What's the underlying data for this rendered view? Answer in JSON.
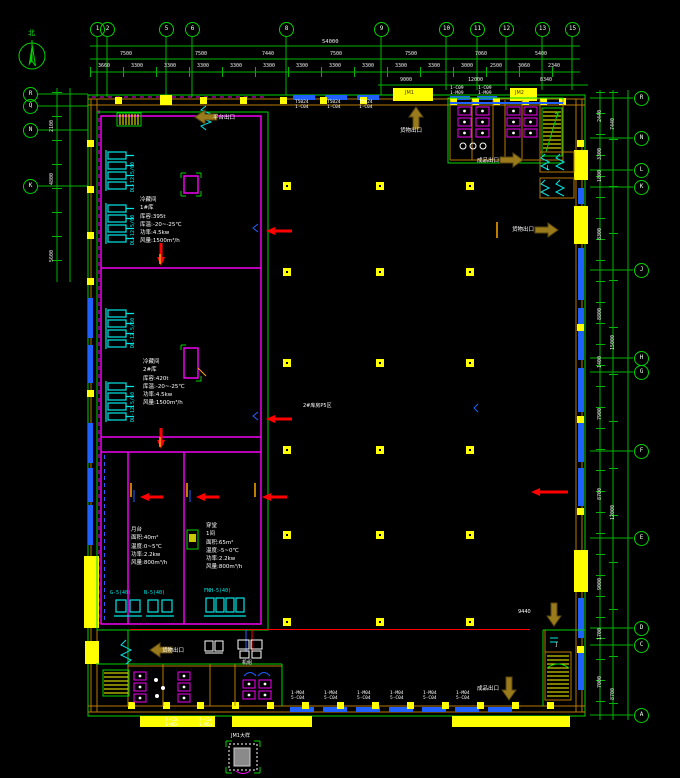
{
  "compass": {
    "label": "北"
  },
  "grid_top": [
    {
      "label": "1",
      "x": 97,
      "y": 29
    },
    {
      "label": "2",
      "x": 107,
      "y": 29
    },
    {
      "label": "5",
      "x": 166,
      "y": 29
    },
    {
      "label": "6",
      "x": 192,
      "y": 29
    },
    {
      "label": "8",
      "x": 286,
      "y": 29
    },
    {
      "label": "9",
      "x": 381,
      "y": 29
    },
    {
      "label": "10",
      "x": 446,
      "y": 29
    },
    {
      "label": "11",
      "x": 477,
      "y": 29
    },
    {
      "label": "12",
      "x": 506,
      "y": 29
    },
    {
      "label": "13",
      "x": 542,
      "y": 29
    },
    {
      "label": "15",
      "x": 572,
      "y": 29
    }
  ],
  "grid_left": [
    {
      "label": "R",
      "x": 30,
      "y": 94
    },
    {
      "label": "Q",
      "x": 30,
      "y": 106
    },
    {
      "label": "N",
      "x": 30,
      "y": 130
    },
    {
      "label": "K",
      "x": 30,
      "y": 186
    }
  ],
  "grid_right": [
    {
      "label": "R",
      "x": 641,
      "y": 98
    },
    {
      "label": "N",
      "x": 641,
      "y": 138
    },
    {
      "label": "L",
      "x": 641,
      "y": 170
    },
    {
      "label": "K",
      "x": 641,
      "y": 187
    },
    {
      "label": "J",
      "x": 641,
      "y": 270
    },
    {
      "label": "H",
      "x": 641,
      "y": 358
    },
    {
      "label": "G",
      "x": 641,
      "y": 372
    },
    {
      "label": "F",
      "x": 641,
      "y": 451
    },
    {
      "label": "E",
      "x": 641,
      "y": 538
    },
    {
      "label": "D",
      "x": 641,
      "y": 628
    },
    {
      "label": "C",
      "x": 641,
      "y": 645
    },
    {
      "label": "A",
      "x": 641,
      "y": 715
    }
  ],
  "dims_top_total": [
    {
      "label": "54000",
      "x": 322,
      "y": 39
    }
  ],
  "dims_top_row1": [
    {
      "label": "7500",
      "x": 120,
      "y": 52
    },
    {
      "label": "7500",
      "x": 195,
      "y": 52
    },
    {
      "label": "7440",
      "x": 262,
      "y": 52
    },
    {
      "label": "7500",
      "x": 330,
      "y": 52
    },
    {
      "label": "7500",
      "x": 405,
      "y": 52
    },
    {
      "label": "7060",
      "x": 475,
      "y": 52
    },
    {
      "label": "5400",
      "x": 535,
      "y": 52
    }
  ],
  "dims_top_row2": [
    {
      "label": "3660",
      "x": 98,
      "y": 64
    },
    {
      "label": "3300",
      "x": 131,
      "y": 64
    },
    {
      "label": "3300",
      "x": 164,
      "y": 64
    },
    {
      "label": "3300",
      "x": 197,
      "y": 64
    },
    {
      "label": "3300",
      "x": 230,
      "y": 64
    },
    {
      "label": "3300",
      "x": 263,
      "y": 64
    },
    {
      "label": "3300",
      "x": 296,
      "y": 64
    },
    {
      "label": "3300",
      "x": 329,
      "y": 64
    },
    {
      "label": "3300",
      "x": 362,
      "y": 64
    },
    {
      "label": "3300",
      "x": 395,
      "y": 64
    },
    {
      "label": "3300",
      "x": 428,
      "y": 64
    },
    {
      "label": "3000",
      "x": 461,
      "y": 64
    },
    {
      "label": "2500",
      "x": 490,
      "y": 64
    },
    {
      "label": "3060",
      "x": 518,
      "y": 64
    },
    {
      "label": "2340",
      "x": 548,
      "y": 64
    }
  ],
  "dims_top_row3": [
    {
      "label": "9000",
      "x": 400,
      "y": 78
    },
    {
      "label": "12000",
      "x": 468,
      "y": 78
    },
    {
      "label": "8340",
      "x": 540,
      "y": 78
    }
  ],
  "dims_left": [
    {
      "label": "2100",
      "x": 50,
      "y": 132,
      "r": -90
    },
    {
      "label": "4800",
      "x": 50,
      "y": 185,
      "r": -90
    },
    {
      "label": "5600",
      "x": 50,
      "y": 262,
      "r": -90
    }
  ],
  "dims_right": [
    {
      "label": "2440",
      "x": 598,
      "y": 122,
      "r": -90
    },
    {
      "label": "3300",
      "x": 598,
      "y": 160,
      "r": -90
    },
    {
      "label": "1800",
      "x": 598,
      "y": 182,
      "r": -90
    },
    {
      "label": "8300",
      "x": 598,
      "y": 240,
      "r": -90
    },
    {
      "label": "8800",
      "x": 598,
      "y": 320,
      "r": -90
    },
    {
      "label": "1400",
      "x": 598,
      "y": 368,
      "r": -90
    },
    {
      "label": "7900",
      "x": 598,
      "y": 420,
      "r": -90
    },
    {
      "label": "8700",
      "x": 598,
      "y": 500,
      "r": -90
    },
    {
      "label": "9000",
      "x": 598,
      "y": 590,
      "r": -90
    },
    {
      "label": "1700",
      "x": 598,
      "y": 640,
      "r": -90
    },
    {
      "label": "7000",
      "x": 598,
      "y": 688,
      "r": -90
    },
    {
      "label": "7440",
      "x": 611,
      "y": 130,
      "r": -90
    },
    {
      "label": "15000",
      "x": 611,
      "y": 350,
      "r": -90
    },
    {
      "label": "12000",
      "x": 611,
      "y": 520,
      "r": -90
    },
    {
      "label": "8700",
      "x": 611,
      "y": 700,
      "r": -90
    }
  ],
  "window_labels_top": [
    {
      "l1": "T5024",
      "l2": "1-C04",
      "x": 295,
      "y": 100
    },
    {
      "l1": "T5024",
      "l2": "1-C04",
      "x": 327,
      "y": 100
    },
    {
      "l1": "T5024",
      "l2": "1-C04",
      "x": 359,
      "y": 100
    },
    {
      "l1": "1-C09",
      "l2": "1-M09",
      "x": 450,
      "y": 86
    },
    {
      "l1": "1-C09",
      "l2": "1-M09",
      "x": 478,
      "y": 86
    }
  ],
  "window_labels_bottom": [
    {
      "l1": "1-M04",
      "l2": "5-C04",
      "x": 291,
      "y": 691
    },
    {
      "l1": "1-M04",
      "l2": "5-C04",
      "x": 324,
      "y": 691
    },
    {
      "l1": "1-M04",
      "l2": "5-C04",
      "x": 357,
      "y": 691
    },
    {
      "l1": "1-M04",
      "l2": "5-C04",
      "x": 390,
      "y": 691
    },
    {
      "l1": "1-M04",
      "l2": "5-C04",
      "x": 423,
      "y": 691
    },
    {
      "l1": "1-M04",
      "l2": "5-C04",
      "x": 456,
      "y": 691
    },
    {
      "l1": "7-C04",
      "l2": "1-M04",
      "x": 165,
      "y": 718
    },
    {
      "l1": "7-C04",
      "l2": "1-M04",
      "x": 199,
      "y": 718
    }
  ],
  "exit_labels": [
    {
      "label": "平台出口",
      "x": 213,
      "y": 113
    },
    {
      "label": "货物出口",
      "x": 400,
      "y": 126
    },
    {
      "label": "成品出口",
      "x": 477,
      "y": 156
    },
    {
      "label": "货物出口",
      "x": 512,
      "y": 225
    },
    {
      "label": "货物出口",
      "x": 162,
      "y": 646
    },
    {
      "label": "成品出口",
      "x": 477,
      "y": 684
    }
  ],
  "floor_labels": [
    {
      "label": "2#库房P5区",
      "x": 303,
      "y": 404
    },
    {
      "label": "9440",
      "x": 518,
      "y": 610
    },
    {
      "label": "JM1",
      "x": 405,
      "y": 91,
      "c": "#4a3a00"
    },
    {
      "label": "JM2",
      "x": 515,
      "y": 91,
      "c": "#4a3a00"
    },
    {
      "label": "J",
      "x": 547,
      "y": 166
    },
    {
      "label": "J",
      "x": 556,
      "y": 643
    },
    {
      "label": "机组",
      "x": 242,
      "y": 661
    },
    {
      "label": "JM1大样",
      "x": 231,
      "y": 734
    }
  ],
  "equip_labels_v": [
    {
      "label": "DL-12.5/60",
      "x": 131,
      "y": 192,
      "r": -90
    },
    {
      "label": "DL-12.5/60",
      "x": 131,
      "y": 245,
      "r": -90
    },
    {
      "label": "DL-12.5/60",
      "x": 131,
      "y": 348,
      "r": -90
    },
    {
      "label": "DL-12.5/60",
      "x": 131,
      "y": 422,
      "r": -90
    }
  ],
  "equip_labels_h": [
    {
      "label": "G-5(40)",
      "x": 110,
      "y": 591
    },
    {
      "label": "N-5(40)",
      "x": 144,
      "y": 591
    },
    {
      "label": "FNH-5(40)",
      "x": 204,
      "y": 589
    }
  ],
  "rooms": {
    "block1": {
      "lines": [
        "冷藏间",
        "1#库",
        "库容:395t",
        "库温:-20~-25℃",
        "功率:4.5kw",
        "风量:1500m³/h"
      ]
    },
    "block2": {
      "lines": [
        "冷藏间",
        "2#库",
        "库容:420t",
        "库温:-20~-25℃",
        "功率:4.5kw",
        "风量:1500m³/h"
      ]
    },
    "block3": {
      "lines": [
        "月台",
        "面积:40m²",
        "温度:0~5℃",
        "功率:2.2kw",
        "风量:800m³/h"
      ]
    },
    "block4": {
      "lines": [
        "穿堂",
        "1间",
        "面积:65m²",
        "温度:-5~0℃",
        "功率:2.2kw",
        "风量:800m³/h"
      ]
    }
  }
}
